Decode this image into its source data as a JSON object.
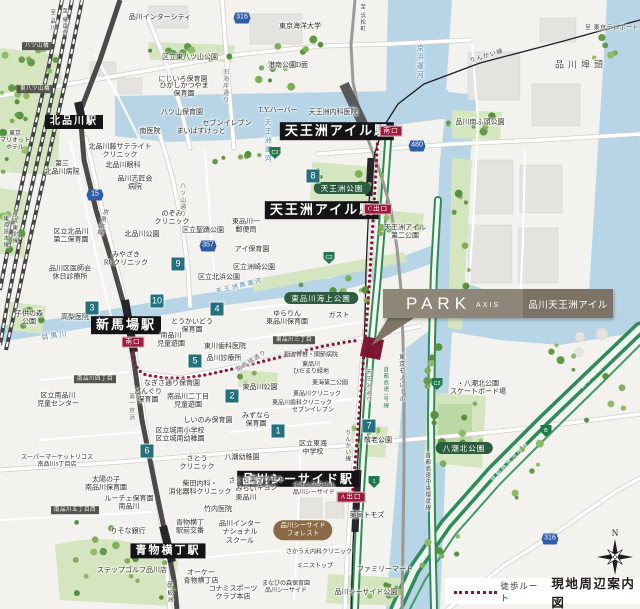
{
  "callout": {
    "brand": "PARK",
    "brand_sub": "AXIS",
    "property": "品川天王洲アイル"
  },
  "legend": {
    "walk_route": "徒歩ルート",
    "map_title": "現地周辺案内図"
  },
  "compass": {
    "north": "N"
  },
  "colors": {
    "water": "#b7d5e6",
    "park": "#d4e5bf",
    "route_dot": "#8e1537",
    "badge": "#23707f",
    "route_shield": "#2e5da9",
    "expwy_shield": "#1e7a4c",
    "station_bg": "#141416",
    "exit_bg": "#9c1b3a",
    "callout_left": "#8e8679",
    "callout_right": "#7c7366",
    "site_marker": "#7d1633"
  },
  "walk_route": {
    "paths": [
      [
        [
          378,
          133
        ],
        [
          376,
          170
        ],
        [
          374,
          205
        ],
        [
          372,
          240
        ],
        [
          370,
          272
        ],
        [
          368,
          304
        ],
        [
          365,
          340
        ],
        [
          362,
          378
        ],
        [
          359,
          415
        ],
        [
          356,
          452
        ],
        [
          353,
          488
        ],
        [
          352,
          500
        ]
      ],
      [
        [
          133,
          346
        ],
        [
          134,
          360
        ],
        [
          138,
          370
        ],
        [
          146,
          375
        ],
        [
          165,
          378
        ],
        [
          185,
          378
        ],
        [
          205,
          375
        ],
        [
          228,
          370
        ],
        [
          252,
          364
        ],
        [
          276,
          358
        ],
        [
          300,
          352
        ],
        [
          324,
          346
        ],
        [
          346,
          342
        ],
        [
          360,
          340
        ]
      ]
    ]
  },
  "number_badges": [
    {
      "n": "8",
      "x": 313,
      "y": 176
    },
    {
      "n": "9",
      "x": 178,
      "y": 264
    },
    {
      "n": "10",
      "x": 157,
      "y": 301
    },
    {
      "n": "3",
      "x": 92,
      "y": 308
    },
    {
      "n": "4",
      "x": 217,
      "y": 309
    },
    {
      "n": "5",
      "x": 195,
      "y": 361
    },
    {
      "n": "2",
      "x": 232,
      "y": 396
    },
    {
      "n": "1",
      "x": 278,
      "y": 431
    },
    {
      "n": "6",
      "x": 147,
      "y": 451
    },
    {
      "n": "7",
      "x": 369,
      "y": 426
    }
  ],
  "route_shields": [
    {
      "n": "316",
      "x": 242,
      "y": 18
    },
    {
      "n": "480",
      "x": 417,
      "y": 146
    },
    {
      "n": "357",
      "x": 208,
      "y": 246
    },
    {
      "n": "15",
      "x": 95,
      "y": 195
    },
    {
      "n": "316",
      "x": 550,
      "y": 539
    }
  ],
  "expwy_shields": [
    {
      "n": "C2",
      "x": 275,
      "y": 153
    },
    {
      "n": "C2",
      "x": 329,
      "y": 258
    },
    {
      "n": "C2",
      "x": 437,
      "y": 384
    },
    {
      "n": "1",
      "x": 374,
      "y": 482
    },
    {
      "n": "B",
      "x": 546,
      "y": 431
    }
  ],
  "labels": [
    {
      "t": "北品川駅",
      "x": 74,
      "y": 122,
      "k": "st",
      "fs": 10
    },
    {
      "t": "天王洲アイル駅",
      "x": 337,
      "y": 131,
      "k": "st"
    },
    {
      "t": "天王洲アイル駅",
      "x": 322,
      "y": 210,
      "k": "st"
    },
    {
      "t": "新馬場駅",
      "x": 126,
      "y": 325,
      "k": "st"
    },
    {
      "t": "品川シーサイド駅",
      "x": 298,
      "y": 479,
      "k": "st",
      "fs": 12
    },
    {
      "t": "青物横丁駅",
      "x": 168,
      "y": 551,
      "k": "st",
      "fs": 11
    },
    {
      "t": "南口",
      "x": 391,
      "y": 131,
      "k": "ex"
    },
    {
      "t": "C出口",
      "x": 378,
      "y": 209,
      "k": "ex"
    },
    {
      "t": "南口",
      "x": 133,
      "y": 342,
      "k": "ex"
    },
    {
      "t": "A出口",
      "x": 351,
      "y": 497,
      "k": "ex"
    },
    {
      "t": "天王洲公園",
      "x": 342,
      "y": 188,
      "k": "pk"
    },
    {
      "t": "東品川海上公園",
      "x": 321,
      "y": 298,
      "k": "pk"
    },
    {
      "t": "八潮北公園",
      "x": 464,
      "y": 448,
      "k": "pk"
    },
    {
      "t": "品川シーサイド\nフォレスト",
      "x": 303,
      "y": 530,
      "k": "ov"
    },
    {
      "t": "八ツ山橋",
      "x": 37,
      "y": 46,
      "k": "sg"
    },
    {
      "t": "東八ツ山橋",
      "x": 35,
      "y": 89,
      "k": "sg"
    },
    {
      "t": "南品川四丁目",
      "x": 95,
      "y": 379,
      "k": "sg"
    },
    {
      "t": "東品川三丁目",
      "x": 294,
      "y": 340,
      "k": "sg"
    },
    {
      "t": "南品川五丁目西",
      "x": 75,
      "y": 510,
      "k": "sg"
    },
    {
      "t": "品川埠頭",
      "x": 581,
      "y": 65,
      "k": "bg"
    },
    {
      "t": "品川インターシティ",
      "x": 160,
      "y": 17,
      "k": "pl"
    },
    {
      "t": "東京海洋大学",
      "x": 300,
      "y": 26,
      "k": "pl"
    },
    {
      "t": "区立東八ツ山公園",
      "x": 190,
      "y": 57,
      "k": "pl"
    },
    {
      "t": "港南公園D面",
      "x": 288,
      "y": 65,
      "k": "pl"
    },
    {
      "t": "にじいろ保育園",
      "x": 183,
      "y": 79,
      "k": "pl"
    },
    {
      "t": "ひがしかつやま\n保育園",
      "x": 184,
      "y": 90,
      "k": "pl"
    },
    {
      "t": "八ツ山保育園",
      "x": 182,
      "y": 112,
      "k": "pl"
    },
    {
      "t": "T.Y.ハーバー",
      "x": 278,
      "y": 110,
      "k": "pl"
    },
    {
      "t": "天王洲内科医院",
      "x": 333,
      "y": 112,
      "k": "pl"
    },
    {
      "t": "南医院",
      "x": 150,
      "y": 131,
      "k": "pl"
    },
    {
      "t": "まいばすけっと",
      "x": 201,
      "y": 131,
      "k": "pl"
    },
    {
      "t": "セブンイレブン",
      "x": 227,
      "y": 123,
      "k": "pl"
    },
    {
      "t": "北品川藤サテライト\nクリニック",
      "x": 120,
      "y": 151,
      "k": "pl"
    },
    {
      "t": "第三\n北品川病院",
      "x": 62,
      "y": 168,
      "k": "pl"
    },
    {
      "t": "北品川眼科",
      "x": 123,
      "y": 165,
      "k": "pl"
    },
    {
      "t": "品川志匠会\n病院",
      "x": 135,
      "y": 183,
      "k": "pl"
    },
    {
      "t": "品川南ふ頭公園",
      "x": 480,
      "y": 122,
      "k": "pl"
    },
    {
      "t": "区立北品川\n第二保育園",
      "x": 71,
      "y": 236,
      "k": "pl"
    },
    {
      "t": "北品川公園",
      "x": 142,
      "y": 234,
      "k": "pl"
    },
    {
      "t": "のぞみ\nクリニック",
      "x": 172,
      "y": 218,
      "k": "pl"
    },
    {
      "t": "区立聖蹟公園",
      "x": 203,
      "y": 230,
      "k": "pl"
    },
    {
      "t": "東品川一\n郵便局",
      "x": 246,
      "y": 226,
      "k": "pl"
    },
    {
      "t": "アイ保育園",
      "x": 252,
      "y": 249,
      "k": "pl"
    },
    {
      "t": "区立洲崎公園",
      "x": 254,
      "y": 267,
      "k": "pl"
    },
    {
      "t": "区立北浜公園",
      "x": 219,
      "y": 277,
      "k": "pl"
    },
    {
      "t": "みやざき\nRCクリニック",
      "x": 126,
      "y": 259,
      "k": "pl"
    },
    {
      "t": "品川区医師会\n休日診療所",
      "x": 70,
      "y": 273,
      "k": "pl"
    },
    {
      "t": "高梨医院",
      "x": 75,
      "y": 317,
      "k": "pl"
    },
    {
      "t": "子供の森\n公園",
      "x": 29,
      "y": 318,
      "k": "pl"
    },
    {
      "t": "とうかいどう\n保育園",
      "x": 192,
      "y": 326,
      "k": "pl"
    },
    {
      "t": "南品川\n児童遊園",
      "x": 171,
      "y": 340,
      "k": "pl"
    },
    {
      "t": "東川歯科医院",
      "x": 225,
      "y": 346,
      "k": "pl"
    },
    {
      "t": "品川診療所",
      "x": 224,
      "y": 358,
      "k": "pl"
    },
    {
      "t": "ゆらりん\n東品川保育園",
      "x": 287,
      "y": 318,
      "k": "pl"
    },
    {
      "t": "稲波脊椎・関節病院",
      "x": 311,
      "y": 356,
      "k": "pl",
      "fs": 6
    },
    {
      "t": "東品川\nひだまり緑地",
      "x": 311,
      "y": 369,
      "k": "pl",
      "fs": 6
    },
    {
      "t": "東品川公園",
      "x": 260,
      "y": 387,
      "k": "pl"
    },
    {
      "t": "東海第二公園",
      "x": 330,
      "y": 384,
      "k": "pl",
      "fs": 6
    },
    {
      "t": "東品川クリニック",
      "x": 317,
      "y": 395,
      "k": "pl",
      "fs": 6
    },
    {
      "t": "東品川歯科クリニック",
      "x": 302,
      "y": 404,
      "k": "pl",
      "fs": 6
    },
    {
      "t": "セブンイレブン",
      "x": 313,
      "y": 411,
      "k": "pl",
      "fs": 6
    },
    {
      "t": "みずなら\n保育園",
      "x": 256,
      "y": 420,
      "k": "pl"
    },
    {
      "t": "なぎさ通り保育園",
      "x": 172,
      "y": 383,
      "k": "pl"
    },
    {
      "t": "どんぐり\n保育園",
      "x": 148,
      "y": 396,
      "k": "pl"
    },
    {
      "t": "南品川二丁目\n児童遊園",
      "x": 188,
      "y": 401,
      "k": "pl"
    },
    {
      "t": "区立南品川\n児童センター",
      "x": 58,
      "y": 400,
      "k": "pl"
    },
    {
      "t": "しいのみ保育園",
      "x": 208,
      "y": 420,
      "k": "pl"
    },
    {
      "t": "区立城南小学校\n区立城南幼稚園",
      "x": 180,
      "y": 435,
      "k": "pl"
    },
    {
      "t": "さとう\nクリニック",
      "x": 197,
      "y": 463,
      "k": "pl"
    },
    {
      "t": "八潮幼稚園",
      "x": 242,
      "y": 457,
      "k": "pl"
    },
    {
      "t": "柴田内科・\n消化器科クリニック",
      "x": 200,
      "y": 488,
      "k": "pl"
    },
    {
      "t": "竹内医院",
      "x": 218,
      "y": 509,
      "k": "pl"
    },
    {
      "t": "青物横丁\n駅前交番",
      "x": 190,
      "y": 527,
      "k": "pl"
    },
    {
      "t": "りそな銀行",
      "x": 128,
      "y": 531,
      "k": "pl"
    },
    {
      "t": "スーパーマーケットリコス\n南品川5丁目店",
      "x": 57,
      "y": 462,
      "k": "pl",
      "fs": 6
    },
    {
      "t": "太陽の子\n南品川保育園",
      "x": 106,
      "y": 484,
      "k": "pl"
    },
    {
      "t": "ルーチェ保育園\n南品川",
      "x": 129,
      "y": 503,
      "k": "pl"
    },
    {
      "t": "ステップゴルフ品川店",
      "x": 132,
      "y": 570,
      "k": "pl"
    },
    {
      "t": "オーケー\n青物横丁店",
      "x": 201,
      "y": 577,
      "k": "pl"
    },
    {
      "t": "コナミスポーツ\nクラブ本店",
      "x": 233,
      "y": 593,
      "k": "pl"
    },
    {
      "t": "品川インター\nナショナル\nスクール",
      "x": 240,
      "y": 532,
      "k": "pl"
    },
    {
      "t": "さくらさく\nみらい\n東品川",
      "x": 246,
      "y": 489,
      "k": "pl"
    },
    {
      "t": "薬マツモト\nキヨシ",
      "x": 267,
      "y": 484,
      "k": "pl"
    },
    {
      "t": "イオンスタイル\n品川シーサイド",
      "x": 314,
      "y": 490,
      "k": "pl",
      "fs": 6
    },
    {
      "t": "さかうえ内科クリニック",
      "x": 319,
      "y": 553,
      "k": "pl",
      "fs": 6
    },
    {
      "t": "ミニストップ",
      "x": 315,
      "y": 567,
      "k": "pl",
      "fs": 6
    },
    {
      "t": "まなびの森保育園\n品川シーサイド",
      "x": 286,
      "y": 588,
      "k": "pl",
      "fs": 6
    },
    {
      "t": "薬局トモズ",
      "x": 367,
      "y": 515,
      "k": "pl"
    },
    {
      "t": "ファミリーマート",
      "x": 385,
      "y": 569,
      "k": "pl"
    },
    {
      "t": "品川シーサイド公園",
      "x": 366,
      "y": 592,
      "k": "pl"
    },
    {
      "t": "敬老公園",
      "x": 378,
      "y": 440,
      "k": "pl"
    },
    {
      "t": "区立東海\n中学校",
      "x": 313,
      "y": 448,
      "k": "pl"
    },
    {
      "t": "・八潮北公園\nスケートボード場",
      "x": 478,
      "y": 388,
      "k": "pl"
    },
    {
      "t": "天王洲アイル\n第二公園",
      "x": 405,
      "y": 232,
      "k": "pl"
    },
    {
      "t": "ガスト",
      "x": 339,
      "y": 315,
      "k": "pl"
    },
    {
      "t": "東京\nマリオット\nホテル",
      "x": 15,
      "y": 142,
      "k": "pl",
      "fs": 6
    },
    {
      "t": "京浜運河",
      "x": 420,
      "y": 62,
      "k": "wa",
      "v": 1
    },
    {
      "t": "天王洲運河",
      "x": 268,
      "y": 141,
      "k": "wa",
      "v": 1
    },
    {
      "t": "目黒川",
      "x": 55,
      "y": 336,
      "k": "wa",
      "r": -8
    },
    {
      "t": "天王洲南運河",
      "x": 240,
      "y": 287,
      "k": "wa",
      "r": -14,
      "fs": 6
    },
    {
      "t": "旧海岸通り",
      "x": 224,
      "y": 86,
      "k": "rd",
      "v": 1
    },
    {
      "t": "八ツ山通り",
      "x": 181,
      "y": 200,
      "k": "rd",
      "v": 1
    },
    {
      "t": "第一京浜",
      "x": 130,
      "y": 407,
      "k": "rd",
      "v": 1
    },
    {
      "t": "南馬場通り",
      "x": 252,
      "y": 362,
      "k": "rd",
      "r": -33
    },
    {
      "t": "天王洲通り",
      "x": 367,
      "y": 386,
      "k": "rd",
      "v": 1
    },
    {
      "t": "京急本線",
      "x": 101,
      "y": 222,
      "k": "rl",
      "v": 1,
      "r": 15
    },
    {
      "t": "東海道本線",
      "x": 5,
      "y": 232,
      "k": "rl",
      "v": 1,
      "fs": 5.5
    },
    {
      "t": "京浜東北線",
      "x": 14,
      "y": 228,
      "k": "rl",
      "v": 1,
      "fs": 5.5
    },
    {
      "t": "東京モノレール",
      "x": 400,
      "y": 378,
      "k": "rl",
      "v": 1
    },
    {
      "t": "りんかい線",
      "x": 487,
      "y": 57,
      "k": "rl",
      "r": -17
    },
    {
      "t": "りんかい線",
      "x": 347,
      "y": 446,
      "k": "rl",
      "v": 1,
      "fs": 5.5
    },
    {
      "t": "至 品川",
      "x": 52,
      "y": 20,
      "k": "rl",
      "v": 1,
      "fs": 5.5
    },
    {
      "t": "至 泉岳寺",
      "x": 64,
      "y": 22,
      "k": "rl",
      "v": 1,
      "fs": 5.5
    },
    {
      "t": "至 浜松町",
      "x": 362,
      "y": 18,
      "k": "rl",
      "v": 1,
      "fs": 5.5
    },
    {
      "t": "至 鮫洲",
      "x": 169,
      "y": 592,
      "k": "rl",
      "v": 1,
      "fs": 5.5
    },
    {
      "t": "至 東京テレポート",
      "x": 612,
      "y": 29,
      "k": "to"
    },
    {
      "t": "首都高速1号線",
      "x": 385,
      "y": 388,
      "k": "gr",
      "v": 1
    },
    {
      "t": "首都高速中央環状線",
      "x": 427,
      "y": 482,
      "k": "rl",
      "v": 1,
      "fs": 5.5
    },
    {
      "t": "首都高速湾岸線",
      "x": 600,
      "y": 370,
      "k": "wg",
      "r": -45
    },
    {
      "t": "首都高速湾岸線",
      "x": 510,
      "y": 462,
      "k": "wg",
      "r": -45
    }
  ]
}
